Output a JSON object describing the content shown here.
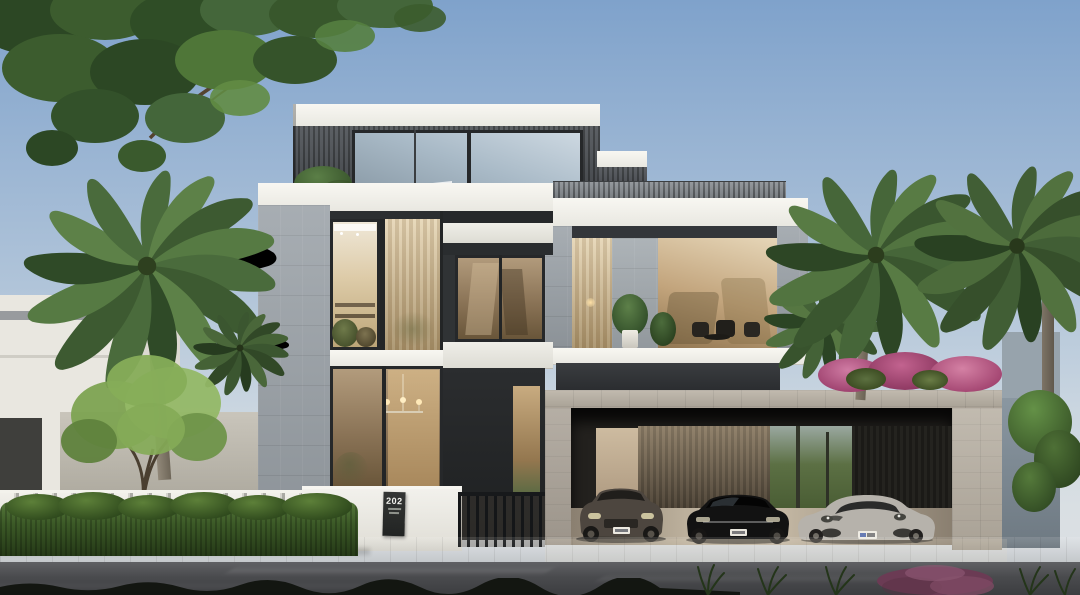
{
  "scene": {
    "type": "photorealistic architectural exterior rendering",
    "description": "Modern three-storey luxury villa at dusk with white fascia bands, grey stone columns, dark vertical-slat cladding, warm lit glazing, a three-car garage, palm trees, hedge and street in the foreground",
    "time_of_day": "dusk",
    "plaque": {
      "number": "202",
      "note": "dark address plaque on white gate wall with two small illegible text lines"
    },
    "villa": {
      "storeys": 3,
      "materials": [
        "white fascia bands",
        "grey stone cladding",
        "dark vertical timber slats",
        "bronze glazing",
        "sheer curtains"
      ],
      "features": [
        "penthouse with corner glass",
        "roof terrace slat railing",
        "balcony with plants and outdoor chairs",
        "double-height entry glazing with linear chandelier",
        "metal picket gate",
        "three-bay garage with timber slat wall"
      ]
    },
    "vehicles": [
      {
        "kind": "suv",
        "color_name": "dark grey-bronze",
        "color": "#4d463f",
        "plate": "white, illegible"
      },
      {
        "kind": "sedan",
        "color_name": "black",
        "color": "#141414",
        "plate": "white, illegible"
      },
      {
        "kind": "sports-car",
        "color_name": "light silver-grey",
        "color": "#b7b3ac",
        "plate": "white, illegible"
      }
    ],
    "vegetation": [
      "deciduous canopy top-left",
      "large date palm left",
      "two date palms right",
      "small bright-green trees left and right",
      "pink bougainvillea over garage roof",
      "long trimmed hedge",
      "ornamental grasses and maroon shrub at street edge"
    ],
    "palette": {
      "sky_top": "#7fa2cb",
      "sky_horizon": "#d9dfe3",
      "fascia_white": "#f4f3ee",
      "slat_cladding": "#3a3e42",
      "stone": "#9ba2a8",
      "garage_stone": "#b7afa2",
      "glass_warm": "#c2a47c",
      "glass_sky": "#a9bac7",
      "hedge_green": "#3c5a27",
      "palm_green": "#4e6f42",
      "bougainvillea_pink": "#c2638f",
      "road": "#4a4b4e",
      "sidewalk": "#8d887e"
    }
  }
}
